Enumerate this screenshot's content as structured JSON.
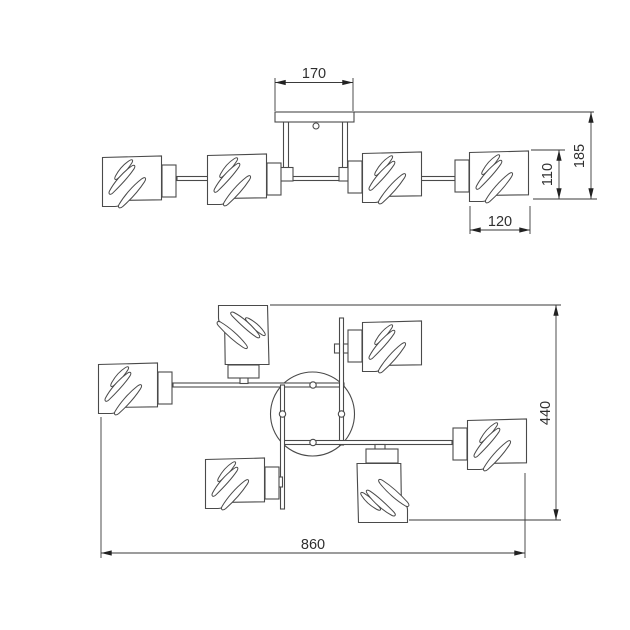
{
  "drawing": {
    "background": "#ffffff",
    "line_color": "#4a4a4a",
    "dimension_color": "#3a3a3a",
    "views": {
      "front": {
        "dims": {
          "canopy_width": "170",
          "overall_height": "185",
          "shade_height": "110",
          "shade_diameter": "120"
        }
      },
      "plan": {
        "dims": {
          "overall_width": "860",
          "overall_depth": "440"
        }
      }
    }
  }
}
